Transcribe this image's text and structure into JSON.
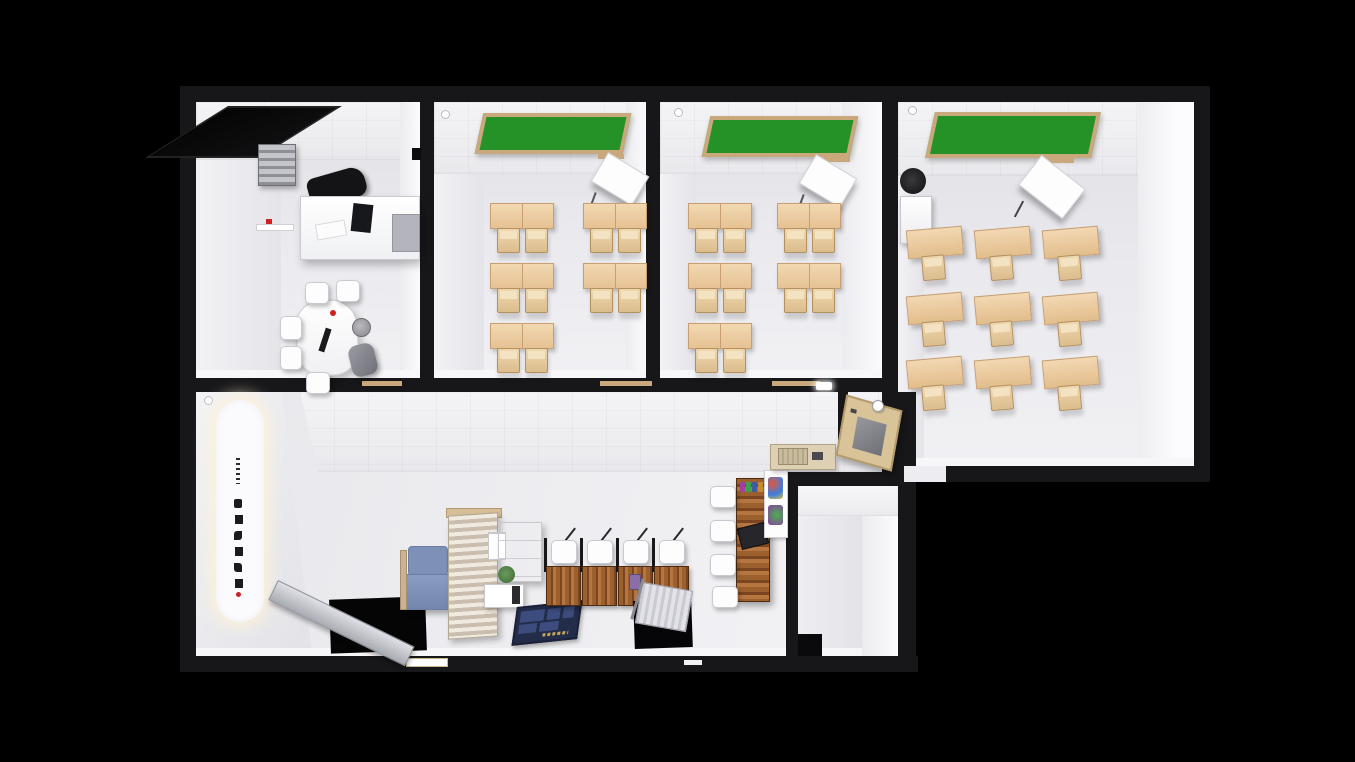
{
  "scene": {
    "description": "3D top-down architectural render of an academy (hagwon) floor plan on black background",
    "view": "isometric cutaway, roof removed",
    "background": "#000000"
  },
  "palette": {
    "bg": "#000000",
    "wallBlack": "#17171a",
    "boardGreen": "#259227",
    "boardFrame": "#c9a87c",
    "metal": "#9a9aa2",
    "sofaBlue": "#7e90b8",
    "sofaBlueDark": "#6d7ea6",
    "matNavy": "#232c49",
    "matPanel": "#3c4c7e",
    "matGold": "#c8a85c",
    "accentRed": "#cc2222"
  },
  "floor_plan": {
    "rooms": [
      {
        "id": "office",
        "type": "office-reception",
        "furniture": [
          "ceiling-skylight-black",
          "ventilation-unit",
          "wall-shelf",
          "l-shaped-reception-desk",
          "monitor",
          "office-chair-black",
          "meeting-table",
          "white-chairs x5",
          "executive-chair-gray",
          "trash-bin"
        ]
      },
      {
        "id": "classroom-1",
        "type": "classroom",
        "furniture": [
          "green-chalkboard",
          "teacher-desk",
          "double-student-desks x5",
          "student-chairs x10"
        ]
      },
      {
        "id": "classroom-2",
        "type": "classroom",
        "furniture": [
          "green-chalkboard",
          "teacher-desk",
          "double-student-desks x5",
          "student-chairs x10"
        ]
      },
      {
        "id": "classroom-3",
        "type": "large-classroom",
        "furniture": [
          "green-chalkboard",
          "lectern",
          "single-student-desks x9",
          "av-speaker",
          "av-cabinet"
        ]
      },
      {
        "id": "study-hall",
        "type": "lobby-study-hall",
        "furniture": [
          "illuminated-vertical-sign",
          "stair-opening-with-ramp x2",
          "lounge-chair-blue",
          "wood-slat-partition",
          "drawer-cabinet",
          "wall-boxes",
          "potted-plant",
          "console-table",
          "entrance-mat-navy",
          "study-carrels x4",
          "communal-study-counter-wood",
          "white-chairs x4",
          "wall-poster",
          "sink-counter",
          "serving-hatch",
          "ceiling-light",
          "wall-dispenser"
        ]
      },
      {
        "id": "storage-room",
        "type": "empty-room",
        "furniture": []
      }
    ],
    "counts": {
      "classrooms": 3,
      "double_desks": 10,
      "single_desks": 9,
      "study_carrels": 4,
      "stair_openings": 2
    }
  },
  "signs": {
    "wall_sign": {
      "script": "korean",
      "orientation": "vertical",
      "legible": false,
      "style": "black logo text on glowing white rounded signboard",
      "accent": "red dot"
    },
    "entrance_mat": {
      "script": "korean",
      "legible": false,
      "style": "gold text strip on navy panel mat"
    }
  }
}
